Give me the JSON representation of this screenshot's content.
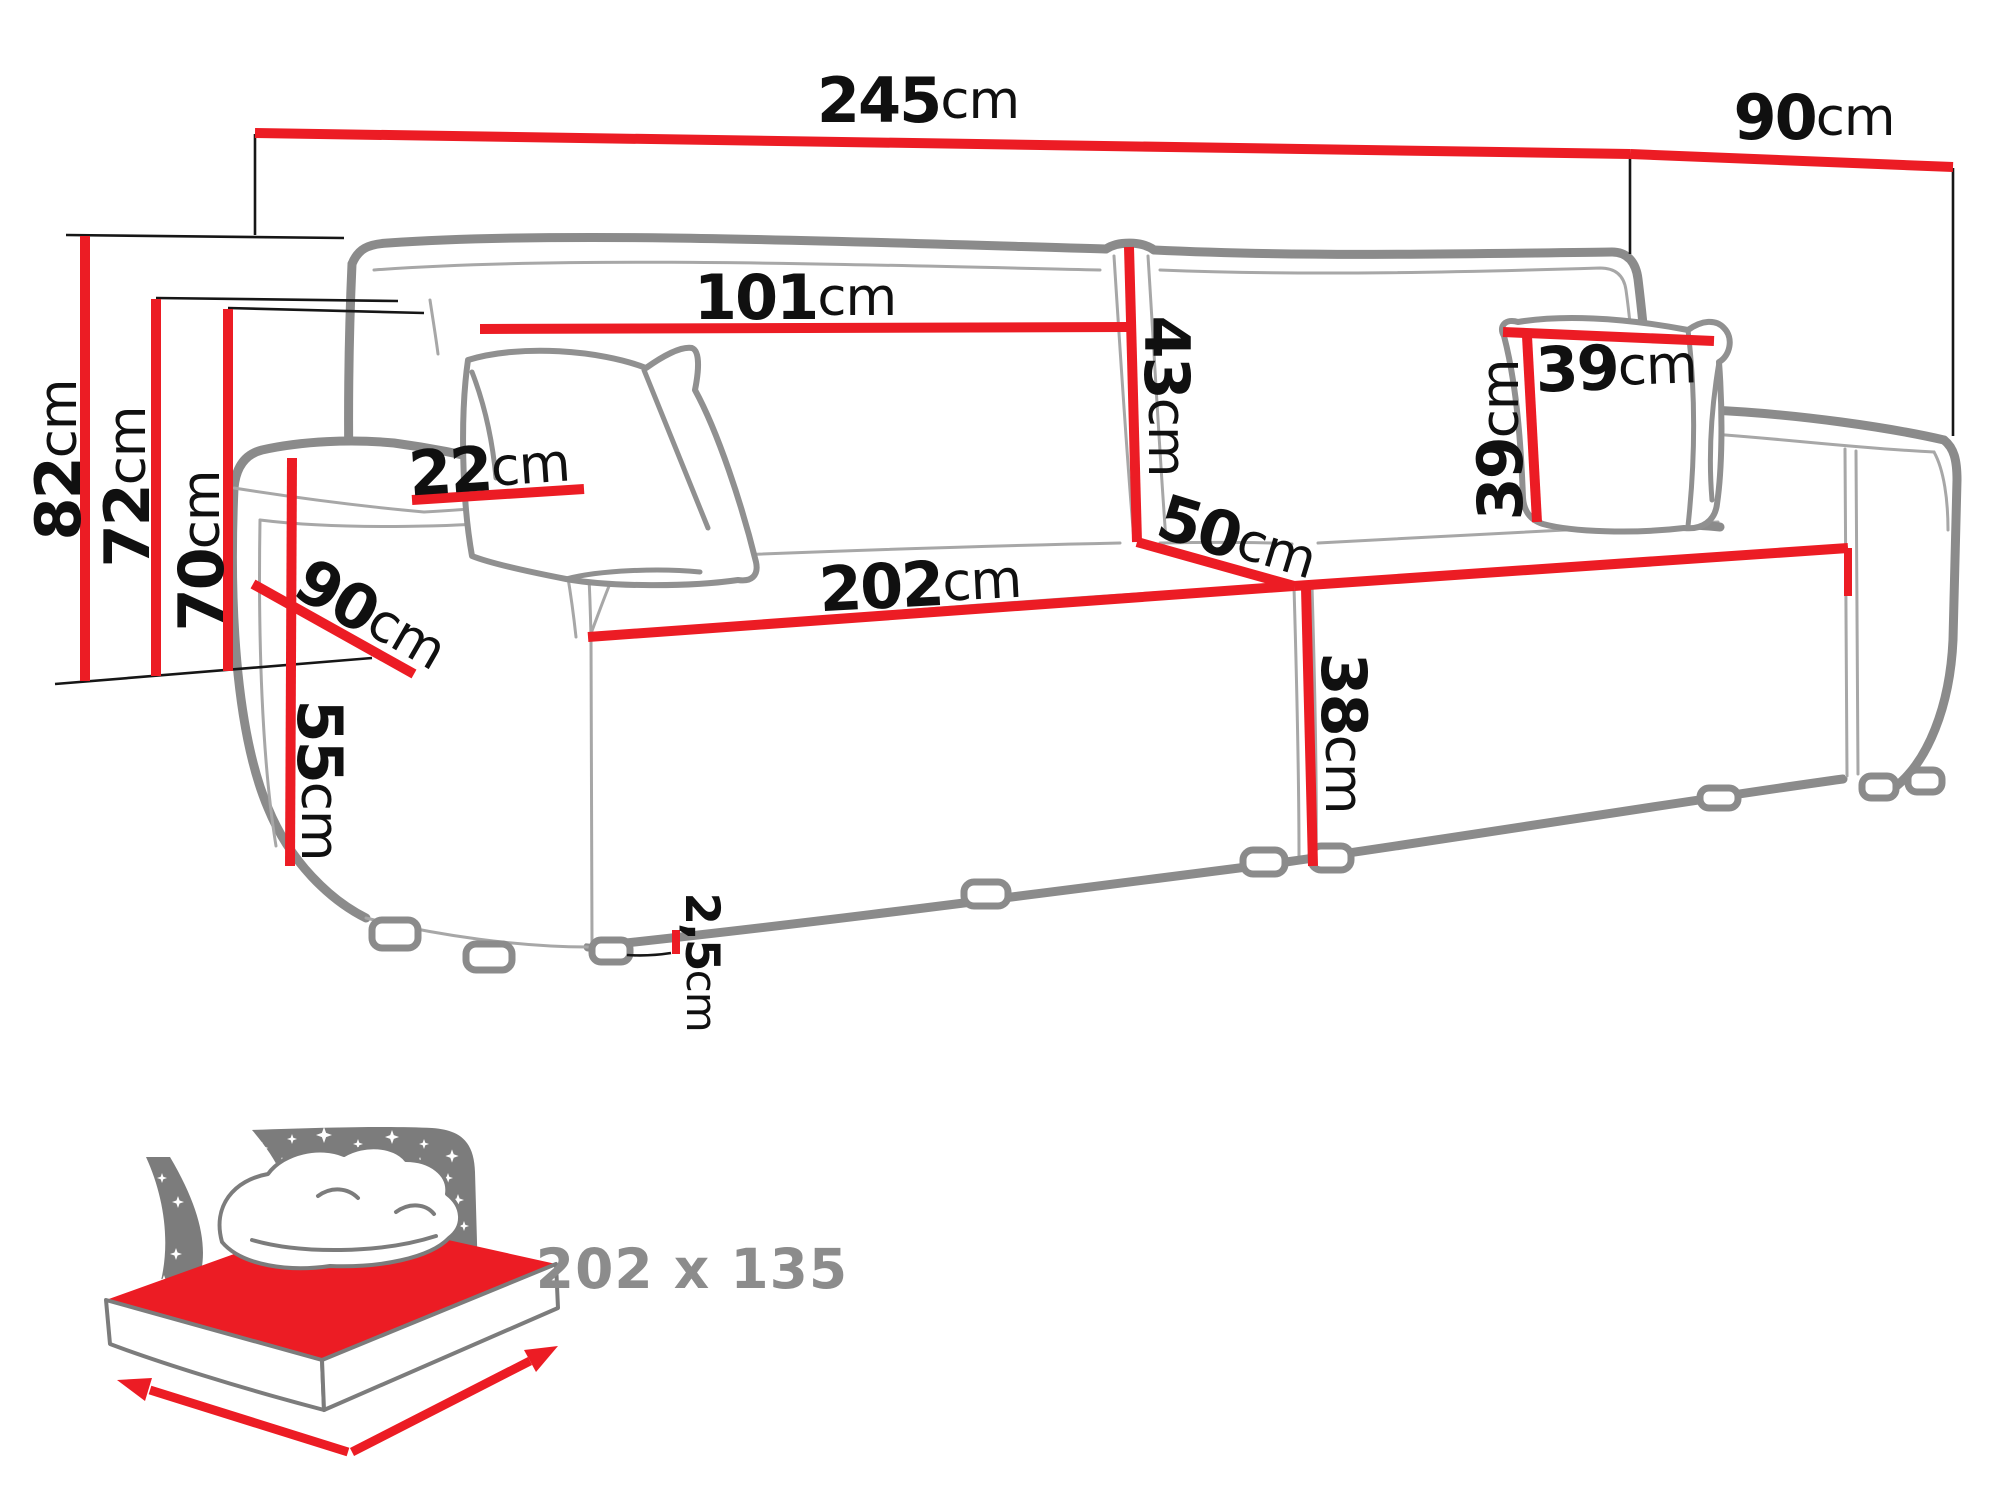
{
  "title": "Sofa dimensions diagram",
  "colors": {
    "dimension_red": "#ec1c24",
    "extension_line_black": "#161616",
    "sofa_outline_gray": "#8b8b8b",
    "icon_gray": "#7c7c7c",
    "icon_text_gray": "#8c8c8c"
  },
  "dims": {
    "total_width": {
      "value": "245",
      "unit": "cm"
    },
    "total_depth": {
      "value": "90",
      "unit": "cm"
    },
    "backrest_width": {
      "value": "101",
      "unit": "cm"
    },
    "back_cushion_height": {
      "value": "43",
      "unit": "cm"
    },
    "pillow_width": {
      "value": "39",
      "unit": "cm"
    },
    "pillow_height": {
      "value": "39",
      "unit": "cm"
    },
    "seat_depth": {
      "value": "50",
      "unit": "cm"
    },
    "seat_length": {
      "value": "202",
      "unit": "cm"
    },
    "seat_front_height": {
      "value": "38",
      "unit": "cm"
    },
    "armrest_width": {
      "value": "22",
      "unit": "cm"
    },
    "armrest_depth": {
      "value": "90",
      "unit": "cm"
    },
    "armrest_height": {
      "value": "55",
      "unit": "cm"
    },
    "overall_height": {
      "value": "82",
      "unit": "cm"
    },
    "backrest_height": {
      "value": "72",
      "unit": "cm"
    },
    "back_height": {
      "value": "70",
      "unit": "cm"
    },
    "legs_height": {
      "value": "2,5",
      "unit": "cm"
    }
  },
  "sleeping_area": {
    "label": "202 x 135"
  }
}
